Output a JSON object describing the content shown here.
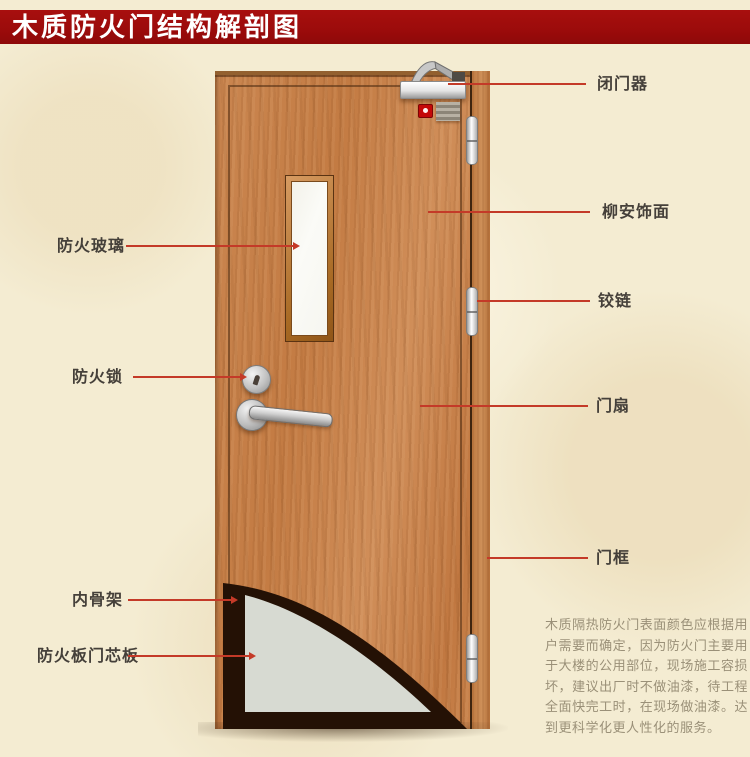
{
  "title": "木质防火门结构解剖图",
  "annotations": {
    "left": [
      {
        "label": "防火玻璃"
      },
      {
        "label": "防火锁"
      },
      {
        "label": "内骨架"
      },
      {
        "label": "防火板门芯板"
      }
    ],
    "right": [
      {
        "label": "闭门器"
      },
      {
        "label": "柳安饰面"
      },
      {
        "label": "铰链"
      },
      {
        "label": "门扇"
      },
      {
        "label": "门框"
      }
    ]
  },
  "description": "木质隔热防火门表面颜色应根据用户需要而确定，因为防火门主要用于大楼的公用部位，现场施工容损坏，建议出厂时不做油漆，待工程全面快完工时，在现场做油漆。达到更科学化更人性化的服务。",
  "colors": {
    "banner_red": "#9B0B0B",
    "background_cream": "#F4ECD2",
    "leader_line_red": "#C43A28",
    "door_wood": "#C98550",
    "core_gray": "#D7DAD2",
    "skeleton_dark": "#241105",
    "glass_white": "#FBFBF7",
    "label_text": "#45403A",
    "description_text": "#9A9078"
  }
}
